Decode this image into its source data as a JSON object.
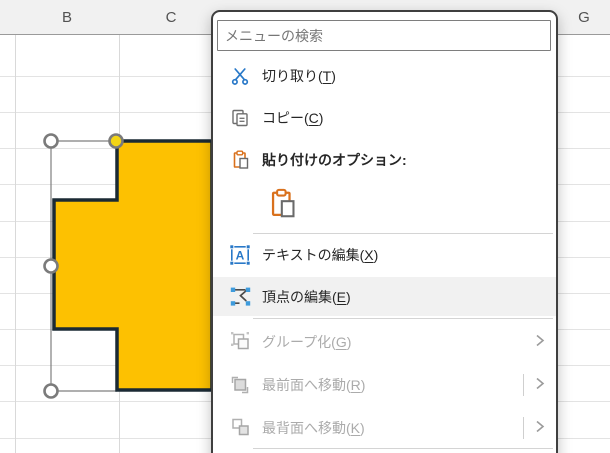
{
  "spreadsheet": {
    "column_headers": [
      "B",
      "C",
      "G"
    ]
  },
  "shape": {
    "type": "freeform-polygon",
    "fill_color": "#FDC101",
    "outline_color": "#1B2A34",
    "adjust_handle_color": "#F3D516"
  },
  "context_menu": {
    "search": {
      "placeholder": "メニューの検索"
    },
    "accent_colors": {
      "office_blue": "#2878C8",
      "clipboard_orange": "#D9711D"
    },
    "items": {
      "cut": {
        "pre": "切り取り(",
        "key": "T",
        "post": ")"
      },
      "copy": {
        "pre": "コピー(",
        "key": "C",
        "post": ")"
      },
      "paste_options": {
        "pre": "貼り付けのオプション:",
        "key": "",
        "post": ""
      },
      "edit_text": {
        "pre": "テキストの編集(",
        "key": "X",
        "post": ")"
      },
      "edit_points": {
        "pre": "頂点の編集(",
        "key": "E",
        "post": ")",
        "highlighted": true
      },
      "group": {
        "pre": "グループ化(",
        "key": "G",
        "post": ")",
        "disabled": true,
        "submenu": true
      },
      "bring_front": {
        "pre": "最前面へ移動(",
        "key": "R",
        "post": ")",
        "disabled": true,
        "submenu": true
      },
      "send_back": {
        "pre": "最背面へ移動(",
        "key": "K",
        "post": ")",
        "disabled": true,
        "submenu": true
      }
    }
  }
}
